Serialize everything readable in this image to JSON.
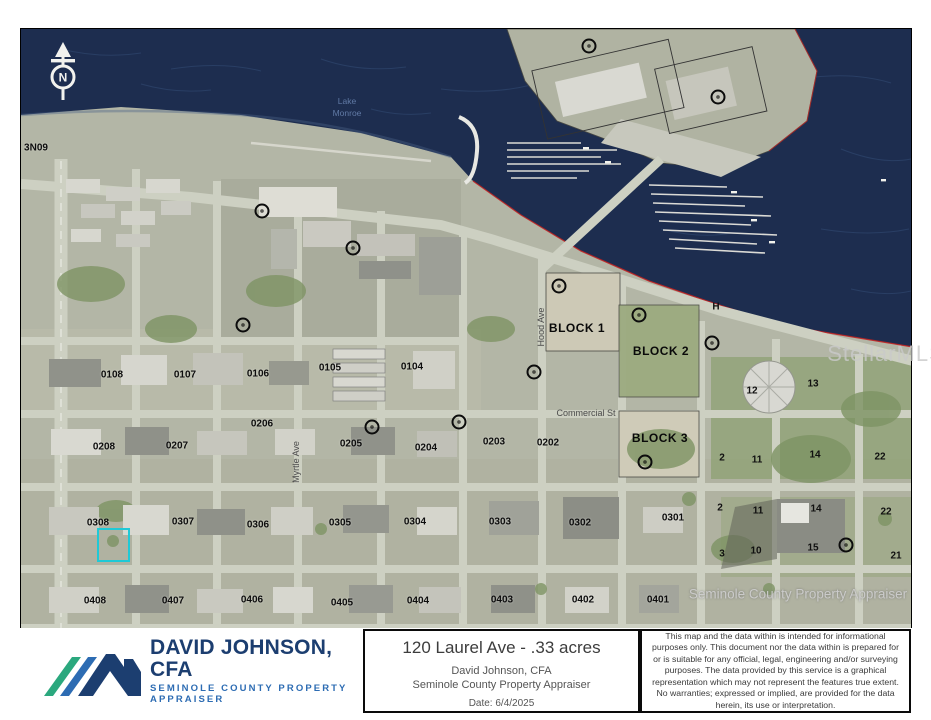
{
  "map": {
    "north_label": "N",
    "highlight": {
      "left": 97,
      "top": 528,
      "width": 33,
      "height": 34,
      "color": "#1fc9d6"
    },
    "labels": [
      {
        "cls": "parcel",
        "name": "area-label",
        "text": "3N09",
        "x": 36,
        "y": 148
      },
      {
        "cls": "water",
        "name": "water-label",
        "text": "Lake",
        "x": 347,
        "y": 101
      },
      {
        "cls": "water",
        "name": "water-label",
        "text": "Monroe",
        "x": 347,
        "y": 113
      },
      {
        "cls": "parcel",
        "name": "parcel-label",
        "text": "0108",
        "x": 112,
        "y": 375
      },
      {
        "cls": "parcel",
        "name": "parcel-label",
        "text": "0107",
        "x": 185,
        "y": 375
      },
      {
        "cls": "parcel",
        "name": "parcel-label",
        "text": "0106",
        "x": 258,
        "y": 374
      },
      {
        "cls": "parcel",
        "name": "parcel-label",
        "text": "0105",
        "x": 330,
        "y": 368
      },
      {
        "cls": "parcel",
        "name": "parcel-label",
        "text": "0104",
        "x": 412,
        "y": 367
      },
      {
        "cls": "parcel",
        "name": "parcel-label",
        "text": "0208",
        "x": 104,
        "y": 447
      },
      {
        "cls": "parcel",
        "name": "parcel-label",
        "text": "0207",
        "x": 177,
        "y": 446
      },
      {
        "cls": "parcel",
        "name": "parcel-label",
        "text": "0206",
        "x": 262,
        "y": 424
      },
      {
        "cls": "parcel",
        "name": "parcel-label",
        "text": "0205",
        "x": 351,
        "y": 444
      },
      {
        "cls": "parcel",
        "name": "parcel-label",
        "text": "0204",
        "x": 426,
        "y": 448
      },
      {
        "cls": "parcel",
        "name": "parcel-label",
        "text": "0203",
        "x": 494,
        "y": 442
      },
      {
        "cls": "parcel",
        "name": "parcel-label",
        "text": "0202",
        "x": 548,
        "y": 443
      },
      {
        "cls": "parcel",
        "name": "parcel-label",
        "text": "0308",
        "x": 98,
        "y": 523
      },
      {
        "cls": "parcel",
        "name": "parcel-label",
        "text": "0307",
        "x": 183,
        "y": 522
      },
      {
        "cls": "parcel",
        "name": "parcel-label",
        "text": "0306",
        "x": 258,
        "y": 525
      },
      {
        "cls": "parcel",
        "name": "parcel-label",
        "text": "0305",
        "x": 340,
        "y": 523
      },
      {
        "cls": "parcel",
        "name": "parcel-label",
        "text": "0304",
        "x": 415,
        "y": 522
      },
      {
        "cls": "parcel",
        "name": "parcel-label",
        "text": "0303",
        "x": 500,
        "y": 522
      },
      {
        "cls": "parcel",
        "name": "parcel-label",
        "text": "0302",
        "x": 580,
        "y": 523
      },
      {
        "cls": "parcel",
        "name": "parcel-label",
        "text": "0301",
        "x": 673,
        "y": 518
      },
      {
        "cls": "parcel",
        "name": "parcel-label",
        "text": "0408",
        "x": 95,
        "y": 601
      },
      {
        "cls": "parcel",
        "name": "parcel-label",
        "text": "0407",
        "x": 173,
        "y": 601
      },
      {
        "cls": "parcel",
        "name": "parcel-label",
        "text": "0406",
        "x": 252,
        "y": 600
      },
      {
        "cls": "parcel",
        "name": "parcel-label",
        "text": "0405",
        "x": 342,
        "y": 603
      },
      {
        "cls": "parcel",
        "name": "parcel-label",
        "text": "0404",
        "x": 418,
        "y": 601
      },
      {
        "cls": "parcel",
        "name": "parcel-label",
        "text": "0403",
        "x": 502,
        "y": 600
      },
      {
        "cls": "parcel",
        "name": "parcel-label",
        "text": "0402",
        "x": 583,
        "y": 600
      },
      {
        "cls": "parcel",
        "name": "parcel-label",
        "text": "0401",
        "x": 658,
        "y": 600
      },
      {
        "cls": "block",
        "name": "block-label",
        "text": "BLOCK 1",
        "x": 577,
        "y": 328
      },
      {
        "cls": "block",
        "name": "block-label",
        "text": "BLOCK 2",
        "x": 661,
        "y": 351
      },
      {
        "cls": "block",
        "name": "block-label",
        "text": "BLOCK 3",
        "x": 660,
        "y": 438
      },
      {
        "cls": "lot",
        "name": "lot-label",
        "text": "H",
        "x": 716,
        "y": 307
      },
      {
        "cls": "lot",
        "name": "lot-label",
        "text": "12",
        "x": 752,
        "y": 391
      },
      {
        "cls": "lot",
        "name": "lot-label",
        "text": "13",
        "x": 813,
        "y": 384
      },
      {
        "cls": "lot",
        "name": "lot-label",
        "text": "2",
        "x": 722,
        "y": 458
      },
      {
        "cls": "lot",
        "name": "lot-label",
        "text": "11",
        "x": 757,
        "y": 460
      },
      {
        "cls": "lot",
        "name": "lot-label",
        "text": "14",
        "x": 815,
        "y": 455
      },
      {
        "cls": "lot",
        "name": "lot-label",
        "text": "22",
        "x": 880,
        "y": 457
      },
      {
        "cls": "lot",
        "name": "lot-label",
        "text": "2",
        "x": 720,
        "y": 508
      },
      {
        "cls": "lot",
        "name": "lot-label",
        "text": "11",
        "x": 758,
        "y": 511
      },
      {
        "cls": "lot",
        "name": "lot-label",
        "text": "14",
        "x": 816,
        "y": 509
      },
      {
        "cls": "lot",
        "name": "lot-label",
        "text": "22",
        "x": 886,
        "y": 512
      },
      {
        "cls": "lot",
        "name": "lot-label",
        "text": "3",
        "x": 722,
        "y": 554
      },
      {
        "cls": "lot",
        "name": "lot-label",
        "text": "10",
        "x": 756,
        "y": 551
      },
      {
        "cls": "lot",
        "name": "lot-label",
        "text": "15",
        "x": 813,
        "y": 548
      },
      {
        "cls": "lot",
        "name": "lot-label",
        "text": "21",
        "x": 896,
        "y": 556
      },
      {
        "cls": "street",
        "name": "street-label",
        "text": "Commercial St",
        "x": 586,
        "y": 413
      },
      {
        "cls": "street",
        "name": "street-label",
        "text": "Myrtle Ave",
        "x": 296,
        "y": 462,
        "rot": -90
      },
      {
        "cls": "street",
        "name": "street-label",
        "text": "Hood Ave",
        "x": 541,
        "y": 327,
        "rot": -90
      },
      {
        "cls": "wm-mls",
        "name": "stellar-mls-watermark",
        "text": "StellarMLS",
        "x": 886,
        "y": 354
      },
      {
        "cls": "wm-app",
        "name": "appraiser-watermark",
        "text": "Seminole County Property Appraiser",
        "x": 798,
        "y": 594
      }
    ],
    "markers": [
      {
        "x": 589,
        "y": 46
      },
      {
        "x": 718,
        "y": 97
      },
      {
        "x": 262,
        "y": 211
      },
      {
        "x": 353,
        "y": 248
      },
      {
        "x": 243,
        "y": 325
      },
      {
        "x": 559,
        "y": 286
      },
      {
        "x": 639,
        "y": 315
      },
      {
        "x": 712,
        "y": 343
      },
      {
        "x": 534,
        "y": 372
      },
      {
        "x": 459,
        "y": 422
      },
      {
        "x": 372,
        "y": 427
      },
      {
        "x": 645,
        "y": 462
      },
      {
        "x": 846,
        "y": 545
      }
    ]
  },
  "footer": {
    "logo": {
      "title": "DAVID JOHNSON, CFA",
      "subtitle": "SEMINOLE COUNTY PROPERTY APPRAISER"
    },
    "title_box": {
      "title": "120 Laurel Ave - .33 acres",
      "line1": "David Johnson, CFA",
      "line2": "Seminole County Property Appraiser",
      "date": "Date: 6/4/2025"
    },
    "disclaimer": "This map and the data within is intended for informational purposes only. This document nor the data within is prepared for or is suitable for any official, legal, engineering and/or surveying purposes. The data provided by this service is a graphical representation which may not represent the features true extent. No warranties; expressed or implied, are provided for the data herein, its use or interpretation."
  }
}
